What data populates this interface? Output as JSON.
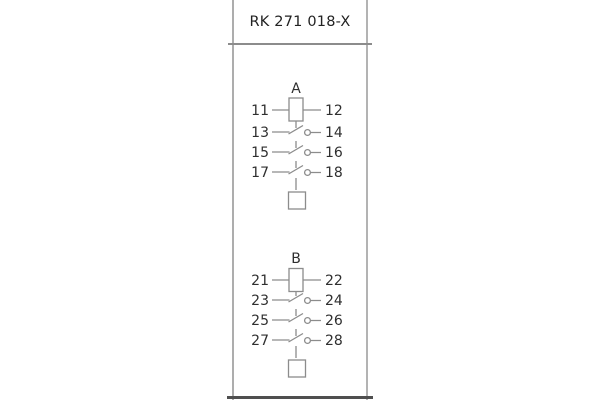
{
  "panel": {
    "title": "RK 271 018-X"
  },
  "sections": [
    {
      "label": "A",
      "left": [
        "11",
        "13",
        "15",
        "17"
      ],
      "right": [
        "12",
        "14",
        "16",
        "18"
      ]
    },
    {
      "label": "B",
      "left": [
        "21",
        "23",
        "25",
        "27"
      ],
      "right": [
        "22",
        "24",
        "26",
        "28"
      ]
    }
  ],
  "colors": {
    "background": "#ffffff",
    "panel_border": "#adadad",
    "header_divider": "#8c8c8c",
    "bottom_edge": "#4f4f4f",
    "schematic_line": "#8c8c8c",
    "text": "#2f2f2f"
  }
}
